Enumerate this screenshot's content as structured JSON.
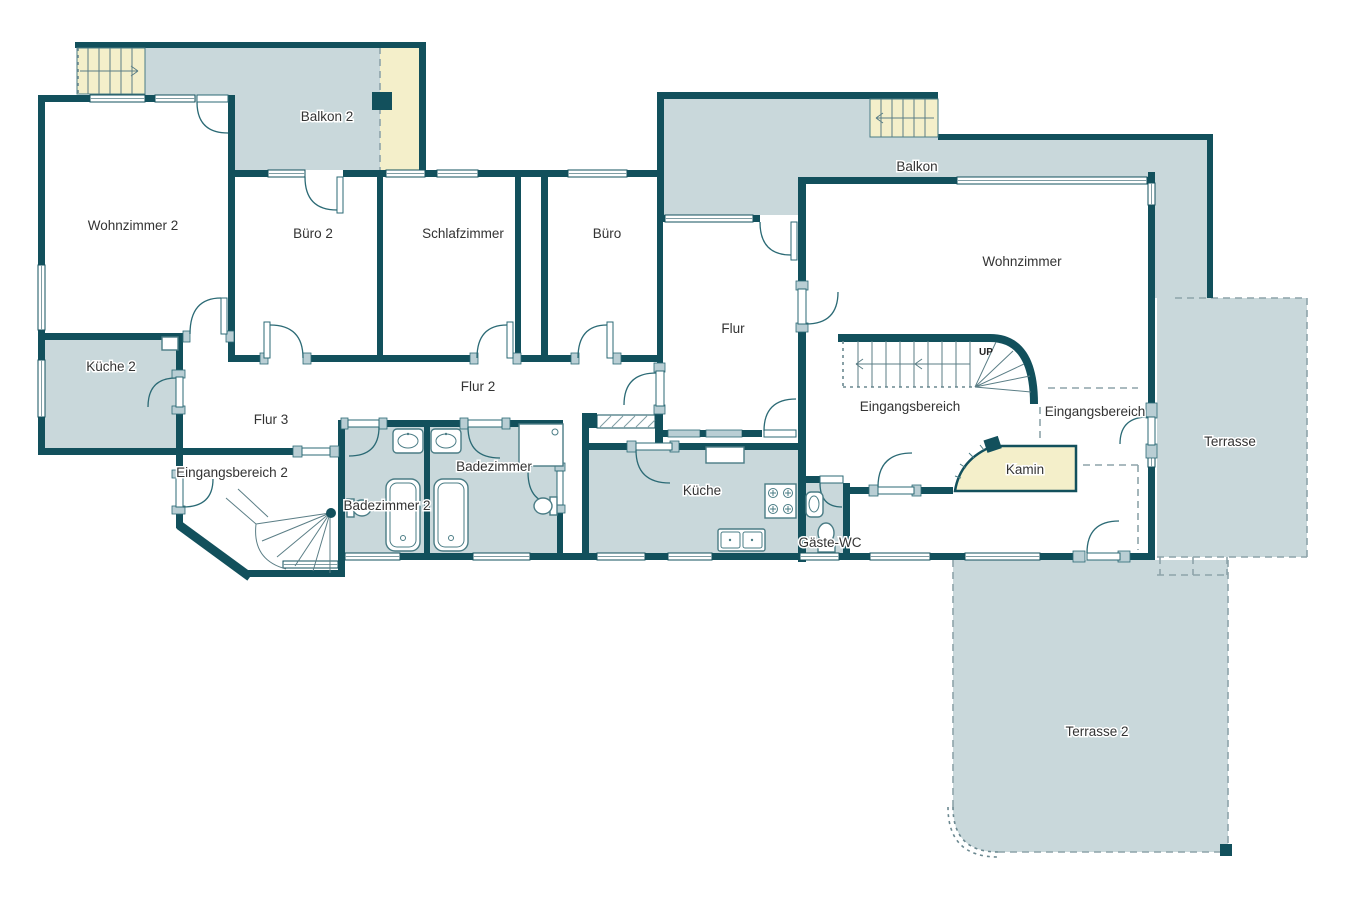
{
  "plan": {
    "type": "floor-plan",
    "language": "de",
    "colors": {
      "wall": "#12505c",
      "wet_outdoor_fill": "#c9d8db",
      "stairs_fireplace_fill": "#f4efca",
      "door_jamb": "#b9ced4",
      "room_fill": "#ffffff",
      "label_text": "#333333"
    },
    "rooms": [
      {
        "id": "wohnzimmer-2",
        "label": "Wohnzimmer 2",
        "x": 133,
        "y": 230
      },
      {
        "id": "balkon-2",
        "label": "Balkon 2",
        "x": 327,
        "y": 121
      },
      {
        "id": "buero-2",
        "label": "Büro 2",
        "x": 313,
        "y": 238
      },
      {
        "id": "schlafzimmer",
        "label": "Schlafzimmer",
        "x": 463,
        "y": 238
      },
      {
        "id": "buero",
        "label": "Büro",
        "x": 607,
        "y": 238
      },
      {
        "id": "flur",
        "label": "Flur",
        "x": 733,
        "y": 333
      },
      {
        "id": "balkon",
        "label": "Balkon",
        "x": 917,
        "y": 171
      },
      {
        "id": "wohnzimmer",
        "label": "Wohnzimmer",
        "x": 1022,
        "y": 266
      },
      {
        "id": "kueche-2",
        "label": "Küche 2",
        "x": 111,
        "y": 371
      },
      {
        "id": "flur-3",
        "label": "Flur 3",
        "x": 271,
        "y": 424
      },
      {
        "id": "flur-2",
        "label": "Flur 2",
        "x": 478,
        "y": 391
      },
      {
        "id": "eingangsbereich-2",
        "label": "Eingangsbereich 2",
        "x": 232,
        "y": 477
      },
      {
        "id": "badezimmer-2",
        "label": "Badezimmer 2",
        "x": 387,
        "y": 510
      },
      {
        "id": "badezimmer",
        "label": "Badezimmer",
        "x": 494,
        "y": 471
      },
      {
        "id": "kueche",
        "label": "Küche",
        "x": 702,
        "y": 495
      },
      {
        "id": "gaeste-wc",
        "label": "Gäste-WC",
        "x": 830,
        "y": 547
      },
      {
        "id": "eingangsbereich",
        "label": "Eingangsbereich",
        "x": 910,
        "y": 411
      },
      {
        "id": "eingangsbereich-b",
        "label": "Eingangsbereich",
        "x": 1095,
        "y": 416
      },
      {
        "id": "kamin",
        "label": "Kamin",
        "x": 1025,
        "y": 474
      },
      {
        "id": "terrasse",
        "label": "Terrasse",
        "x": 1230,
        "y": 446
      },
      {
        "id": "terrasse-2",
        "label": "Terrasse 2",
        "x": 1097,
        "y": 736
      },
      {
        "id": "stair-up",
        "label": "UP",
        "x": 986,
        "y": 355
      }
    ]
  }
}
